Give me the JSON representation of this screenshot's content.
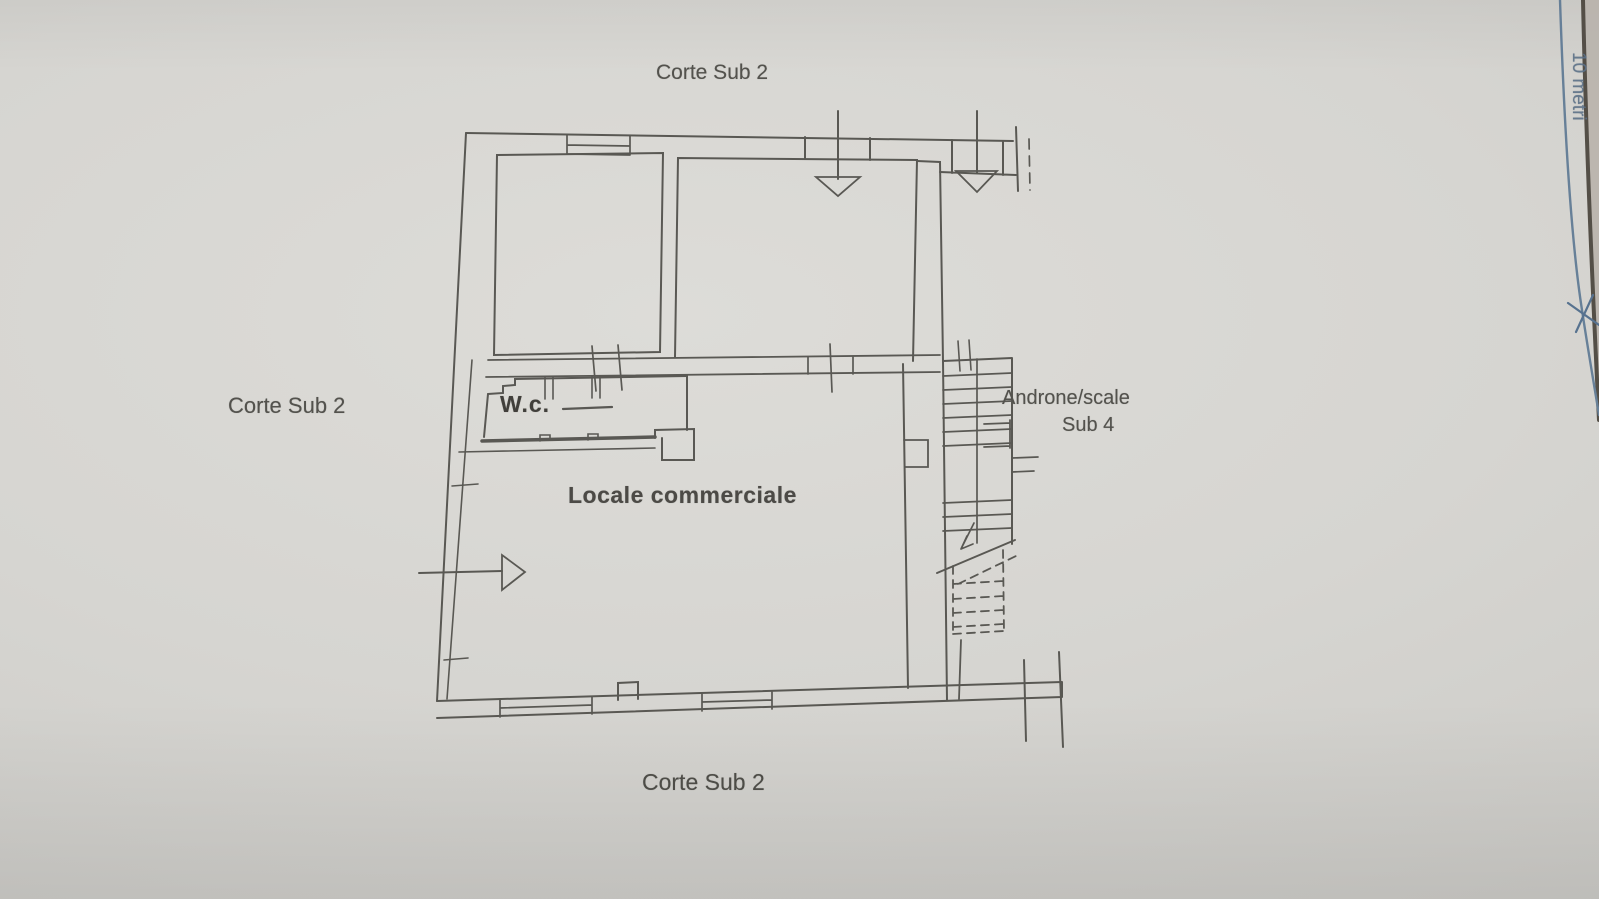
{
  "photo": {
    "labels": {
      "corte_top": "Corte Sub 2",
      "corte_left": "Corte Sub 2",
      "corte_bottom": "Corte Sub 2",
      "wc": "W.c.",
      "locale_commerciale": "Locale commerciale",
      "androne_scale": "Androne/scale",
      "sub_4": "Sub 4",
      "edge_ruler": "10 metri"
    },
    "colors": {
      "paper": "#d5d4d0",
      "ink": "#4f4e49",
      "label_text": "#53524d",
      "ruler_blue": "#5e7994",
      "paper_edge": "#4a443c"
    }
  }
}
